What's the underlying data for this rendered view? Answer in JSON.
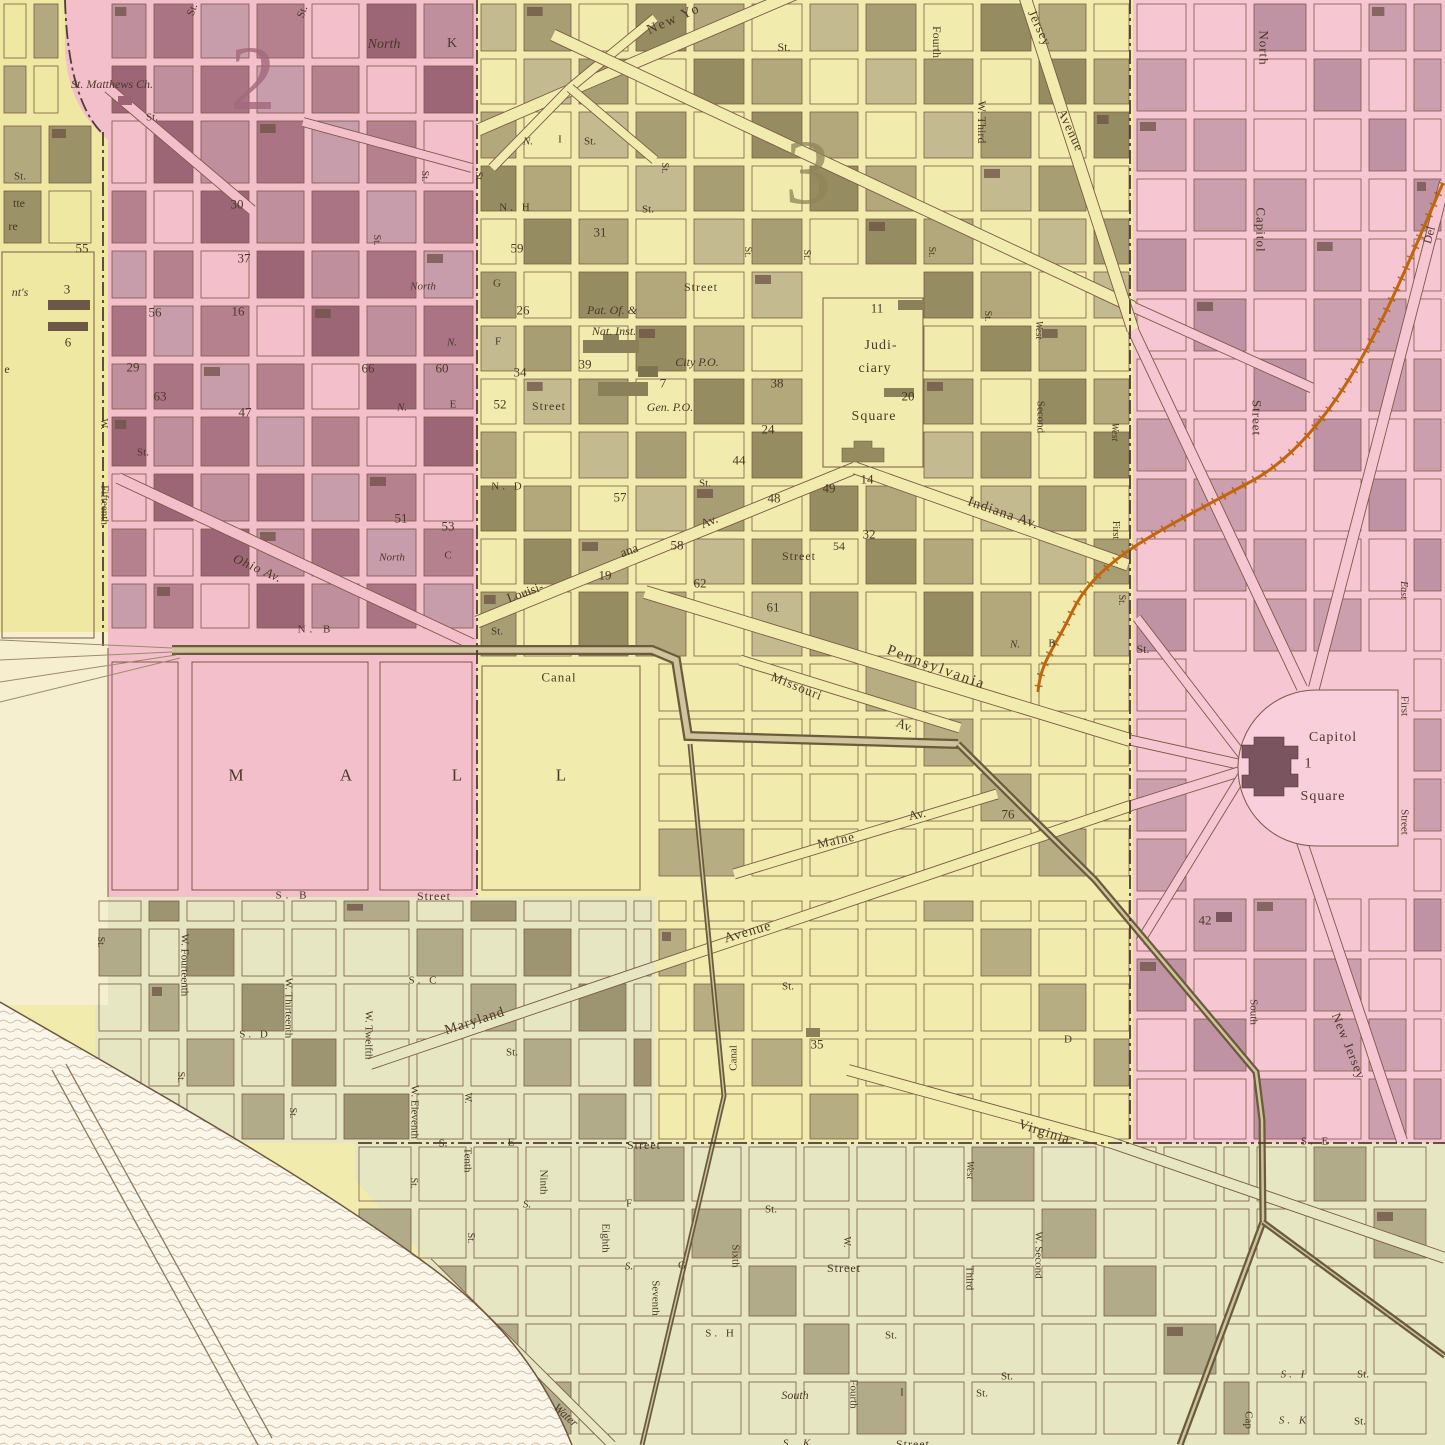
{
  "map": {
    "kind": "antique-engraved-city-ward-map",
    "colors": {
      "ward_pink": "#f3bfcb",
      "capitol_pink": "#f6c6d2",
      "city_yellow": "#f1ecae",
      "left_yellow": "#efe8a2",
      "south_green": "#e6e7c2",
      "cream": "#f5efcf",
      "water": "#faf6ea",
      "block_mauve": "#ab7484",
      "block_olive": "#aca37b",
      "railroad_orange": "#c2660e",
      "canal_brown": "#6b5b3d",
      "ink": "#4b3827"
    },
    "labels": [
      {
        "t": "2",
        "x": 253,
        "y": 78,
        "s": 92,
        "c": "#a4687c",
        "o": 0.8
      },
      {
        "t": "3",
        "x": 808,
        "y": 172,
        "s": 92,
        "c": "#8e8557",
        "o": 0.75
      },
      {
        "t": "St.",
        "x": 193,
        "y": 10,
        "r": -70,
        "s": 11
      },
      {
        "t": "St.",
        "x": 303,
        "y": 12,
        "r": -70,
        "s": 11
      },
      {
        "t": "North",
        "x": 384,
        "y": 45,
        "s": 14,
        "i": true
      },
      {
        "t": "K",
        "x": 452,
        "y": 44,
        "s": 14
      },
      {
        "t": "St. Matthews Ch.",
        "x": 112,
        "y": 84,
        "s": 12,
        "i": true
      },
      {
        "t": "St.",
        "x": 152,
        "y": 118,
        "s": 11
      },
      {
        "t": "New Yo",
        "x": 674,
        "y": 20,
        "r": -24,
        "s": 14,
        "ls": 2
      },
      {
        "t": "St.",
        "x": 784,
        "y": 47,
        "s": 12
      },
      {
        "t": "Fourth",
        "x": 937,
        "y": 42,
        "r": 90,
        "s": 12
      },
      {
        "t": "W. Third",
        "x": 982,
        "y": 122,
        "r": 90,
        "s": 12
      },
      {
        "t": "Jersey",
        "x": 1040,
        "y": 28,
        "r": 65,
        "s": 13,
        "ls": 1
      },
      {
        "t": "Avenue",
        "x": 1071,
        "y": 130,
        "r": 65,
        "s": 13,
        "ls": 1
      },
      {
        "t": "North",
        "x": 1264,
        "y": 48,
        "r": 90,
        "s": 13,
        "ls": 1
      },
      {
        "t": "Capitol",
        "x": 1261,
        "y": 230,
        "r": 90,
        "s": 13,
        "ls": 1
      },
      {
        "t": "Street",
        "x": 1257,
        "y": 418,
        "r": 90,
        "s": 13,
        "ls": 1
      },
      {
        "t": "Del",
        "x": 1429,
        "y": 235,
        "r": -75,
        "s": 12
      },
      {
        "t": "30",
        "x": 237,
        "y": 204,
        "s": 13
      },
      {
        "t": "37",
        "x": 244,
        "y": 258,
        "s": 13
      },
      {
        "t": "St.",
        "x": 424,
        "y": 176,
        "r": 90,
        "s": 10
      },
      {
        "t": "St.",
        "x": 478,
        "y": 177,
        "r": 90,
        "s": 10
      },
      {
        "t": "St.",
        "x": 376,
        "y": 240,
        "r": 90,
        "s": 10
      },
      {
        "t": "North",
        "x": 423,
        "y": 287,
        "s": 11,
        "i": true
      },
      {
        "t": "55",
        "x": 82,
        "y": 248,
        "s": 13
      },
      {
        "t": "3",
        "x": 67,
        "y": 289,
        "s": 13
      },
      {
        "t": "6",
        "x": 68,
        "y": 342,
        "s": 13
      },
      {
        "t": "56",
        "x": 155,
        "y": 312,
        "s": 13
      },
      {
        "t": "16",
        "x": 238,
        "y": 311,
        "s": 13
      },
      {
        "t": "29",
        "x": 133,
        "y": 367,
        "s": 13
      },
      {
        "t": "63",
        "x": 160,
        "y": 396,
        "s": 13
      },
      {
        "t": "66",
        "x": 368,
        "y": 368,
        "s": 13
      },
      {
        "t": "60",
        "x": 442,
        "y": 368,
        "s": 13
      },
      {
        "t": "47",
        "x": 245,
        "y": 412,
        "s": 13
      },
      {
        "t": "N.",
        "x": 452,
        "y": 343,
        "s": 11,
        "i": true
      },
      {
        "t": "W.",
        "x": 103,
        "y": 424,
        "r": 90,
        "s": 10
      },
      {
        "t": "Fifteenth",
        "x": 104,
        "y": 505,
        "r": 90,
        "s": 11
      },
      {
        "t": "St.",
        "x": 143,
        "y": 453,
        "s": 11
      },
      {
        "t": "N.",
        "x": 402,
        "y": 408,
        "s": 11,
        "i": true
      },
      {
        "t": "E",
        "x": 453,
        "y": 405,
        "s": 11
      },
      {
        "t": "51",
        "x": 401,
        "y": 518,
        "s": 13
      },
      {
        "t": "53",
        "x": 448,
        "y": 526,
        "s": 13
      },
      {
        "t": "Ohio Av.",
        "x": 258,
        "y": 568,
        "r": 24,
        "s": 13,
        "i": true,
        "ls": 1
      },
      {
        "t": "North",
        "x": 392,
        "y": 558,
        "s": 11,
        "i": true
      },
      {
        "t": "C",
        "x": 448,
        "y": 556,
        "s": 11
      },
      {
        "t": "N. B",
        "x": 316,
        "y": 630,
        "s": 11,
        "ls": 4
      },
      {
        "t": "St.",
        "x": 497,
        "y": 632,
        "s": 11
      },
      {
        "t": "St.",
        "x": 20,
        "y": 177,
        "s": 11
      },
      {
        "t": "tte",
        "x": 19,
        "y": 203,
        "s": 12
      },
      {
        "t": "re",
        "x": 13,
        "y": 226,
        "s": 12
      },
      {
        "t": "nt's",
        "x": 20,
        "y": 292,
        "s": 12,
        "i": true
      },
      {
        "t": "e",
        "x": 7,
        "y": 369,
        "s": 12
      },
      {
        "t": "N.",
        "x": 528,
        "y": 142,
        "s": 11,
        "i": true
      },
      {
        "t": "I",
        "x": 560,
        "y": 140,
        "s": 11
      },
      {
        "t": "St.",
        "x": 590,
        "y": 142,
        "s": 11
      },
      {
        "t": "St.",
        "x": 664,
        "y": 168,
        "r": 90,
        "s": 10
      },
      {
        "t": "N. H",
        "x": 516,
        "y": 208,
        "s": 11,
        "ls": 3
      },
      {
        "t": "St.",
        "x": 648,
        "y": 210,
        "s": 11
      },
      {
        "t": "59",
        "x": 517,
        "y": 248,
        "s": 13
      },
      {
        "t": "31",
        "x": 600,
        "y": 232,
        "s": 13
      },
      {
        "t": "G",
        "x": 497,
        "y": 284,
        "s": 11
      },
      {
        "t": "Street",
        "x": 701,
        "y": 287,
        "s": 12,
        "ls": 1
      },
      {
        "t": "26",
        "x": 523,
        "y": 310,
        "s": 13
      },
      {
        "t": "Pat. Of. &",
        "x": 612,
        "y": 310,
        "s": 12,
        "i": true
      },
      {
        "t": "Nat. Inst.",
        "x": 614,
        "y": 331,
        "s": 12,
        "i": true
      },
      {
        "t": "F",
        "x": 498,
        "y": 342,
        "s": 11
      },
      {
        "t": "34",
        "x": 520,
        "y": 372,
        "s": 13
      },
      {
        "t": "39",
        "x": 585,
        "y": 364,
        "s": 13
      },
      {
        "t": "City P.O.",
        "x": 697,
        "y": 362,
        "s": 12,
        "i": true
      },
      {
        "t": "7",
        "x": 663,
        "y": 383,
        "s": 13
      },
      {
        "t": "38",
        "x": 777,
        "y": 383,
        "s": 13
      },
      {
        "t": "52",
        "x": 500,
        "y": 404,
        "s": 13
      },
      {
        "t": "Street",
        "x": 549,
        "y": 406,
        "s": 12,
        "ls": 1
      },
      {
        "t": "Gen. P.O.",
        "x": 670,
        "y": 407,
        "s": 12,
        "i": true
      },
      {
        "t": "St.",
        "x": 747,
        "y": 252,
        "r": 90,
        "s": 10
      },
      {
        "t": "St.",
        "x": 806,
        "y": 255,
        "r": 90,
        "s": 10
      },
      {
        "t": "St.",
        "x": 931,
        "y": 252,
        "r": 90,
        "s": 10
      },
      {
        "t": "11",
        "x": 877,
        "y": 308,
        "s": 13
      },
      {
        "t": "Judi-",
        "x": 881,
        "y": 346,
        "s": 14,
        "ls": 1
      },
      {
        "t": "ciary",
        "x": 875,
        "y": 369,
        "s": 14,
        "ls": 1
      },
      {
        "t": "20",
        "x": 908,
        "y": 396,
        "s": 13
      },
      {
        "t": "Square",
        "x": 874,
        "y": 417,
        "s": 14,
        "ls": 1
      },
      {
        "t": "St.",
        "x": 987,
        "y": 316,
        "r": 90,
        "s": 10
      },
      {
        "t": "West",
        "x": 1038,
        "y": 330,
        "r": 90,
        "s": 10,
        "i": true
      },
      {
        "t": "Second",
        "x": 1040,
        "y": 417,
        "r": 90,
        "s": 11
      },
      {
        "t": "24",
        "x": 768,
        "y": 429,
        "s": 13
      },
      {
        "t": "44",
        "x": 739,
        "y": 460,
        "s": 13
      },
      {
        "t": "14",
        "x": 867,
        "y": 479,
        "s": 13
      },
      {
        "t": "48",
        "x": 774,
        "y": 498,
        "s": 13
      },
      {
        "t": "49",
        "x": 829,
        "y": 488,
        "s": 13
      },
      {
        "t": "N. D",
        "x": 508,
        "y": 487,
        "s": 11,
        "ls": 3
      },
      {
        "t": "57",
        "x": 620,
        "y": 497,
        "s": 13
      },
      {
        "t": "St.",
        "x": 705,
        "y": 484,
        "s": 11
      },
      {
        "t": "Indiana Av.",
        "x": 1003,
        "y": 514,
        "r": 19,
        "s": 14,
        "ls": 1
      },
      {
        "t": "32",
        "x": 869,
        "y": 534,
        "s": 13
      },
      {
        "t": "54",
        "x": 839,
        "y": 546,
        "s": 12
      },
      {
        "t": "Street",
        "x": 799,
        "y": 556,
        "s": 12,
        "ls": 1
      },
      {
        "t": "Av.",
        "x": 709,
        "y": 521,
        "r": -22,
        "s": 13
      },
      {
        "t": "58",
        "x": 677,
        "y": 545,
        "s": 13
      },
      {
        "t": "ana",
        "x": 629,
        "y": 550,
        "r": -20,
        "s": 13
      },
      {
        "t": "Louisi-",
        "x": 525,
        "y": 592,
        "r": -20,
        "s": 13
      },
      {
        "t": "19",
        "x": 605,
        "y": 575,
        "s": 13
      },
      {
        "t": "62",
        "x": 700,
        "y": 583,
        "s": 13
      },
      {
        "t": "61",
        "x": 773,
        "y": 607,
        "s": 13
      },
      {
        "t": "Pennsylvania",
        "x": 936,
        "y": 668,
        "r": 20,
        "s": 15,
        "ls": 2
      },
      {
        "t": "Missouri",
        "x": 797,
        "y": 686,
        "r": 22,
        "s": 13,
        "ls": 1
      },
      {
        "t": "Av.",
        "x": 905,
        "y": 725,
        "r": 22,
        "s": 13
      },
      {
        "t": "N.",
        "x": 1015,
        "y": 645,
        "s": 11,
        "i": true
      },
      {
        "t": "B",
        "x": 1052,
        "y": 644,
        "s": 11
      },
      {
        "t": "St.",
        "x": 1143,
        "y": 649,
        "s": 12
      },
      {
        "t": "West",
        "x": 1114,
        "y": 432,
        "r": 90,
        "s": 10,
        "i": true
      },
      {
        "t": "First",
        "x": 1115,
        "y": 530,
        "r": 90,
        "s": 10
      },
      {
        "t": "St.",
        "x": 1121,
        "y": 600,
        "r": 90,
        "s": 10
      },
      {
        "t": "76",
        "x": 1008,
        "y": 814,
        "s": 13
      },
      {
        "t": "Maine",
        "x": 836,
        "y": 840,
        "r": -12,
        "s": 13,
        "ls": 1
      },
      {
        "t": "Av.",
        "x": 917,
        "y": 814,
        "r": -12,
        "s": 13
      },
      {
        "t": "Canal",
        "x": 559,
        "y": 677,
        "s": 13,
        "ls": 1
      },
      {
        "t": "M",
        "x": 236,
        "y": 775,
        "s": 17
      },
      {
        "t": "A",
        "x": 346,
        "y": 775,
        "s": 17
      },
      {
        "t": "L",
        "x": 457,
        "y": 775,
        "s": 17
      },
      {
        "t": "L",
        "x": 561,
        "y": 775,
        "s": 17
      },
      {
        "t": "Capitol",
        "x": 1333,
        "y": 738,
        "s": 14,
        "ls": 1
      },
      {
        "t": "1",
        "x": 1308,
        "y": 764,
        "s": 15
      },
      {
        "t": "Square",
        "x": 1323,
        "y": 797,
        "s": 14,
        "ls": 1
      },
      {
        "t": "East",
        "x": 1403,
        "y": 590,
        "r": 90,
        "s": 10,
        "i": true
      },
      {
        "t": "First",
        "x": 1404,
        "y": 706,
        "r": 90,
        "s": 11
      },
      {
        "t": "Street",
        "x": 1404,
        "y": 822,
        "r": 90,
        "s": 11
      },
      {
        "t": "42",
        "x": 1205,
        "y": 920,
        "s": 13
      },
      {
        "t": "South",
        "x": 1253,
        "y": 1012,
        "r": 90,
        "s": 11
      },
      {
        "t": "New Jersey",
        "x": 1349,
        "y": 1046,
        "r": 68,
        "s": 13,
        "ls": 1
      },
      {
        "t": "S. E",
        "x": 1316,
        "y": 1142,
        "s": 11,
        "ls": 3
      },
      {
        "t": "S. B",
        "x": 293,
        "y": 896,
        "s": 11,
        "ls": 4
      },
      {
        "t": "Street",
        "x": 434,
        "y": 896,
        "s": 12,
        "ls": 1
      },
      {
        "t": "St.",
        "x": 100,
        "y": 942,
        "r": 90,
        "s": 10
      },
      {
        "t": "W. Fourteenth",
        "x": 184,
        "y": 965,
        "r": 90,
        "s": 11
      },
      {
        "t": "St.",
        "x": 180,
        "y": 1077,
        "r": 90,
        "s": 10
      },
      {
        "t": "W. Thirteenth",
        "x": 288,
        "y": 1008,
        "r": 90,
        "s": 11
      },
      {
        "t": "St.",
        "x": 292,
        "y": 1113,
        "r": 90,
        "s": 10
      },
      {
        "t": "S. C",
        "x": 424,
        "y": 981,
        "s": 11,
        "ls": 3
      },
      {
        "t": "S. D",
        "x": 255,
        "y": 1035,
        "s": 11,
        "ls": 3
      },
      {
        "t": "W. Twelfth",
        "x": 368,
        "y": 1035,
        "r": 90,
        "s": 11
      },
      {
        "t": "Maryland",
        "x": 475,
        "y": 1022,
        "r": -18,
        "s": 14,
        "ls": 1
      },
      {
        "t": "Avenue",
        "x": 748,
        "y": 933,
        "r": -16,
        "s": 14,
        "ls": 1
      },
      {
        "t": "St.",
        "x": 512,
        "y": 1053,
        "s": 11
      },
      {
        "t": "W. Eleventh",
        "x": 414,
        "y": 1112,
        "r": 90,
        "s": 11
      },
      {
        "t": "St.",
        "x": 413,
        "y": 1183,
        "r": 90,
        "s": 10
      },
      {
        "t": "W.",
        "x": 467,
        "y": 1098,
        "r": 90,
        "s": 10
      },
      {
        "t": "Tenth",
        "x": 467,
        "y": 1160,
        "r": 90,
        "s": 11
      },
      {
        "t": "St.",
        "x": 470,
        "y": 1238,
        "r": 90,
        "s": 10
      },
      {
        "t": "S.",
        "x": 443,
        "y": 1144,
        "s": 11
      },
      {
        "t": "E",
        "x": 511,
        "y": 1143,
        "s": 11
      },
      {
        "t": "Street",
        "x": 644,
        "y": 1145,
        "s": 12,
        "ls": 1
      },
      {
        "t": "Ninth",
        "x": 543,
        "y": 1182,
        "r": 90,
        "s": 11
      },
      {
        "t": "S.",
        "x": 527,
        "y": 1205,
        "s": 11,
        "i": true
      },
      {
        "t": "F",
        "x": 629,
        "y": 1204,
        "s": 11
      },
      {
        "t": "St.",
        "x": 771,
        "y": 1210,
        "s": 11
      },
      {
        "t": "Eighth",
        "x": 605,
        "y": 1238,
        "r": 90,
        "s": 11
      },
      {
        "t": "Seventh",
        "x": 655,
        "y": 1298,
        "r": 90,
        "s": 11
      },
      {
        "t": "Sixth",
        "x": 735,
        "y": 1256,
        "r": 90,
        "s": 11
      },
      {
        "t": "S.",
        "x": 629,
        "y": 1267,
        "s": 11,
        "i": true
      },
      {
        "t": "G",
        "x": 682,
        "y": 1266,
        "s": 11
      },
      {
        "t": "Street",
        "x": 844,
        "y": 1268,
        "s": 12,
        "ls": 1
      },
      {
        "t": "W.",
        "x": 846,
        "y": 1242,
        "r": 90,
        "s": 10
      },
      {
        "t": "S. H",
        "x": 721,
        "y": 1334,
        "s": 11,
        "ls": 3
      },
      {
        "t": "St.",
        "x": 891,
        "y": 1336,
        "s": 11
      },
      {
        "t": "South",
        "x": 795,
        "y": 1395,
        "s": 12,
        "i": true
      },
      {
        "t": "Fourth",
        "x": 853,
        "y": 1394,
        "r": 90,
        "s": 11
      },
      {
        "t": "I",
        "x": 902,
        "y": 1393,
        "s": 11
      },
      {
        "t": "St.",
        "x": 982,
        "y": 1394,
        "s": 11
      },
      {
        "t": "S. K",
        "x": 798,
        "y": 1444,
        "s": 11,
        "i": true,
        "ls": 3
      },
      {
        "t": "Street",
        "x": 913,
        "y": 1444,
        "s": 12,
        "ls": 1
      },
      {
        "t": "Water",
        "x": 566,
        "y": 1415,
        "r": 42,
        "s": 12,
        "i": true
      },
      {
        "t": "Canal",
        "x": 734,
        "y": 1058,
        "r": -90,
        "s": 11
      },
      {
        "t": "Virginia",
        "x": 1044,
        "y": 1133,
        "r": 18,
        "s": 14,
        "ls": 1
      },
      {
        "t": "West",
        "x": 969,
        "y": 1170,
        "r": 90,
        "s": 10,
        "i": true
      },
      {
        "t": "Third",
        "x": 969,
        "y": 1278,
        "r": 90,
        "s": 11
      },
      {
        "t": "W. Second",
        "x": 1038,
        "y": 1255,
        "r": 90,
        "s": 11
      },
      {
        "t": "St.",
        "x": 1007,
        "y": 1377,
        "s": 11
      },
      {
        "t": "D",
        "x": 1068,
        "y": 1040,
        "s": 11
      },
      {
        "t": "35",
        "x": 817,
        "y": 1044,
        "s": 13
      },
      {
        "t": "St.",
        "x": 788,
        "y": 987,
        "s": 11
      },
      {
        "t": "S. I",
        "x": 1294,
        "y": 1375,
        "s": 11,
        "i": true,
        "ls": 3
      },
      {
        "t": "St.",
        "x": 1363,
        "y": 1375,
        "s": 11
      },
      {
        "t": "S. K",
        "x": 1294,
        "y": 1421,
        "s": 11,
        "i": true,
        "ls": 3
      },
      {
        "t": "St.",
        "x": 1360,
        "y": 1422,
        "s": 11
      },
      {
        "t": "Cap",
        "x": 1248,
        "y": 1420,
        "r": 90,
        "s": 11
      }
    ]
  }
}
